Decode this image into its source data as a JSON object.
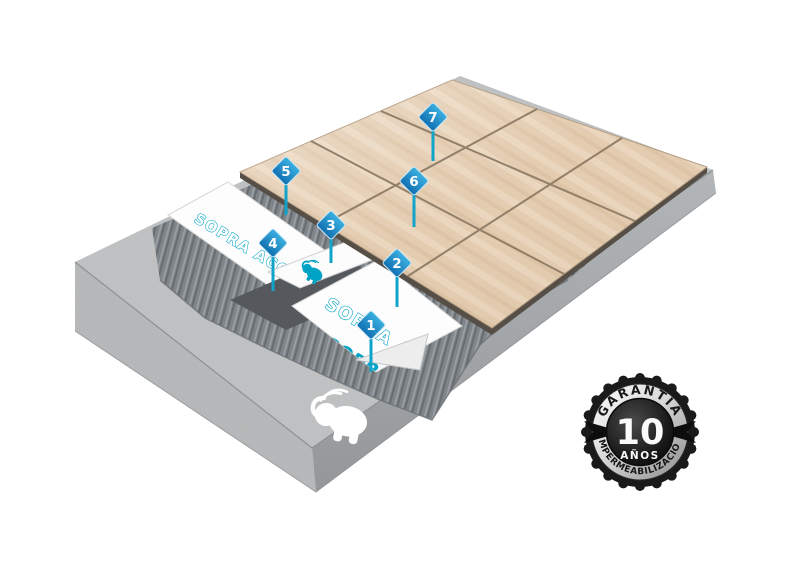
{
  "diagram": {
    "markers": [
      {
        "label": "1"
      },
      {
        "label": "2"
      },
      {
        "label": "3"
      },
      {
        "label": "4"
      },
      {
        "label": "5"
      },
      {
        "label": "6"
      },
      {
        "label": "7"
      }
    ],
    "sheets": [
      {
        "product": "SOPRA ACQUA",
        "brand": "SOPREMA"
      },
      {
        "product": "SOPRA ACQUA",
        "brand": "SOPREMA"
      }
    ],
    "icons": {
      "elephant": "soprema-elephant-logo"
    }
  },
  "badge": {
    "arc_top": "GARANTÍA",
    "number": "10",
    "years": "AÑOS",
    "arc_bottom": "IMPERMEABILIZACIÓN"
  },
  "colors": {
    "marker_blue_light": "#3bb0e0",
    "marker_blue_dark": "#1170b2",
    "stem_teal": "#12a3c9",
    "membrane_teal": "#00a3c6",
    "tile_beige": "#e2c9ac",
    "concrete_gray": "#bfc1c2",
    "mortar_gray": "#80858a",
    "badge_black": "#1a1a1a"
  }
}
